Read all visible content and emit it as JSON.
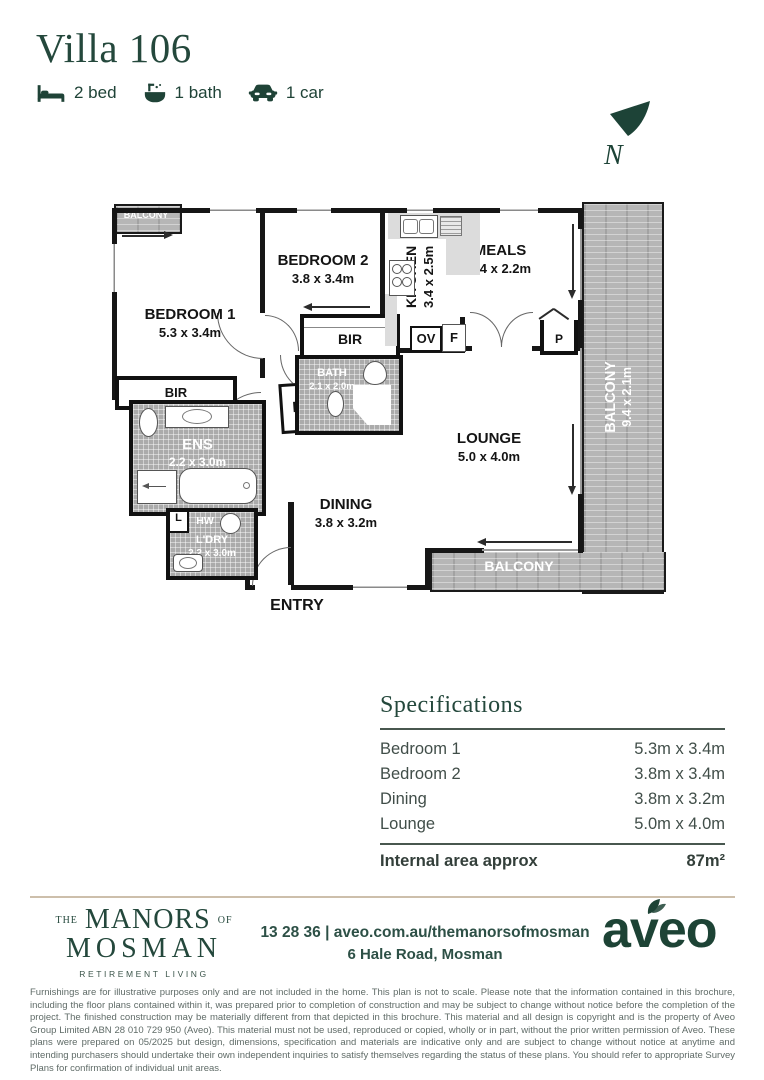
{
  "page": {
    "title": "Villa 106"
  },
  "features": [
    {
      "icon": "bed-icon",
      "label": "2 bed"
    },
    {
      "icon": "bath-icon",
      "label": "1 bath"
    },
    {
      "icon": "car-icon",
      "label": "1 car"
    }
  ],
  "compass": {
    "label": "N"
  },
  "floorplan": {
    "balcony_top": {
      "name": "BALCONY"
    },
    "bedroom1": {
      "name": "BEDROOM 1",
      "dims": "5.3 x 3.4m"
    },
    "bedroom2": {
      "name": "BEDROOM 2",
      "dims": "3.8 x 3.4m"
    },
    "kitchen": {
      "name": "KITCHEN",
      "dims": "3.4 x 2.5m"
    },
    "meals": {
      "name": "MEALS",
      "dims": "3.4 x 2.2m"
    },
    "balcony_right": {
      "name": "BALCONY",
      "dims": "9.4 x 2.1m"
    },
    "bir1": {
      "name": "BIR"
    },
    "bir2": {
      "name": "BIR"
    },
    "oven": {
      "name": "OV"
    },
    "fridge": {
      "name": "F"
    },
    "pantry": {
      "name": "P"
    },
    "bath": {
      "name": "BATH",
      "dims": "2.1 x 2.0m"
    },
    "linen_hall": {
      "name": "L"
    },
    "linen_ldry": {
      "name": "L"
    },
    "ens": {
      "name": "ENS",
      "dims": "2.2 x 3.0m"
    },
    "hot_water": {
      "name": "HW"
    },
    "laundry": {
      "name": "L'DRY",
      "dims": "2.2 x 3.0m"
    },
    "lounge": {
      "name": "LOUNGE",
      "dims": "5.0 x 4.0m"
    },
    "dining": {
      "name": "DINING",
      "dims": "3.8 x 3.2m"
    },
    "balcony_bottom": {
      "name": "BALCONY"
    },
    "entry": {
      "name": "ENTRY"
    }
  },
  "specifications": {
    "title": "Specifications",
    "rows": [
      {
        "label": "Bedroom 1",
        "value": "5.3m x 3.4m"
      },
      {
        "label": "Bedroom 2",
        "value": "3.8m x 3.4m"
      },
      {
        "label": "Dining",
        "value": "3.8m x 3.2m"
      },
      {
        "label": "Lounge",
        "value": "5.0m x 4.0m"
      }
    ],
    "total_label": "Internal area approx",
    "total_value": "87m²"
  },
  "footer": {
    "brand": {
      "the": "THE",
      "manors": "MANORS",
      "of": "OF",
      "mosman": "MOSMAN",
      "tagline": "RETIREMENT LIVING"
    },
    "contact_line1": "13 28 36 | aveo.com.au/themanorsofmosman",
    "contact_line2": "6 Hale Road, Mosman",
    "logo": "aveo"
  },
  "disclaimer": "Furnishings are for illustrative purposes only and are not included in the home. This plan is not to scale. Please note that the information contained in this brochure, including the floor plans contained within it, was prepared prior to completion of construction and may be subject to change without notice before the completion of the project. The finished construction may be materially different from that depicted in this brochure. This material and all design is copyright and is the property of Aveo Group Limited ABN 28 010 729 950 (Aveo). This material must not be used, reproduced or copied, wholly or in part, without the prior written permission of Aveo. These plans were prepared on 05/2025 but design, dimensions, specification and materials are indicative only and are subject to change without notice at anytime and intending purchasers should undertake their own independent inquiries to satisfy themselves regarding the status of these plans. You should refer to appropriate Survey Plans for confirmation of individual unit areas.",
  "colors": {
    "brand_green": "#24483c",
    "wall_black": "#161616",
    "hatch_gray": "#b6b6b6",
    "tile_gray": "#ababab"
  }
}
